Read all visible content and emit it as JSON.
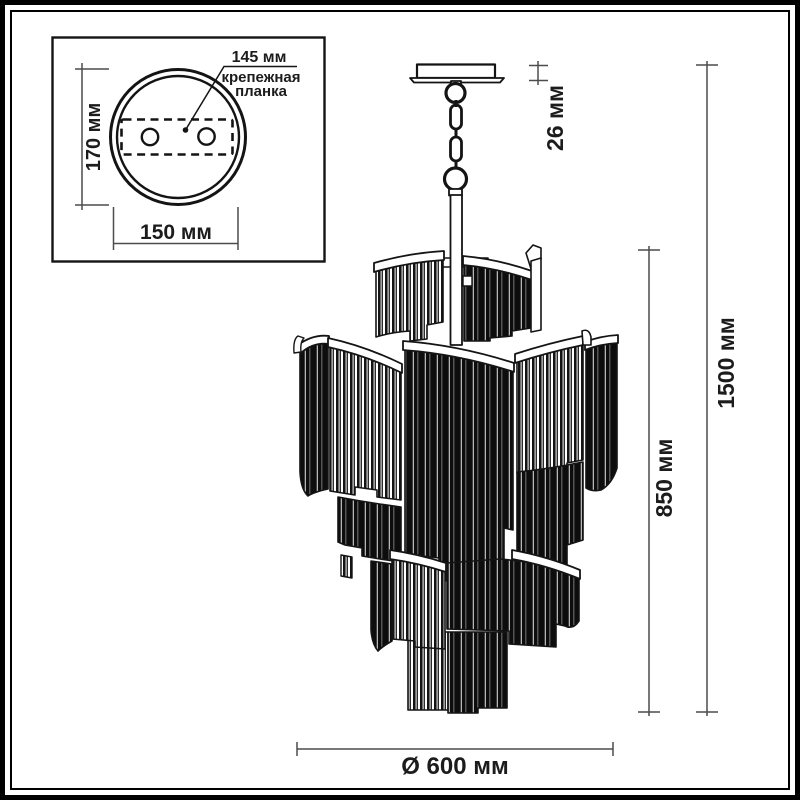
{
  "inset": {
    "dim_bracket_length": "145 мм",
    "bracket_label_line1": "крепежная",
    "bracket_label_line2": "планка",
    "dim_canopy_diameter": "170 мм",
    "dim_bracket_width": "150 мм"
  },
  "main_dims": {
    "canopy_height": "26 мм",
    "body_height": "850 мм",
    "total_height": "1500 мм",
    "diameter": "Ø 600 мм"
  },
  "colors": {
    "ink": "#141414",
    "dimension_line": "#4c4c4c",
    "background": "#ffffff"
  }
}
